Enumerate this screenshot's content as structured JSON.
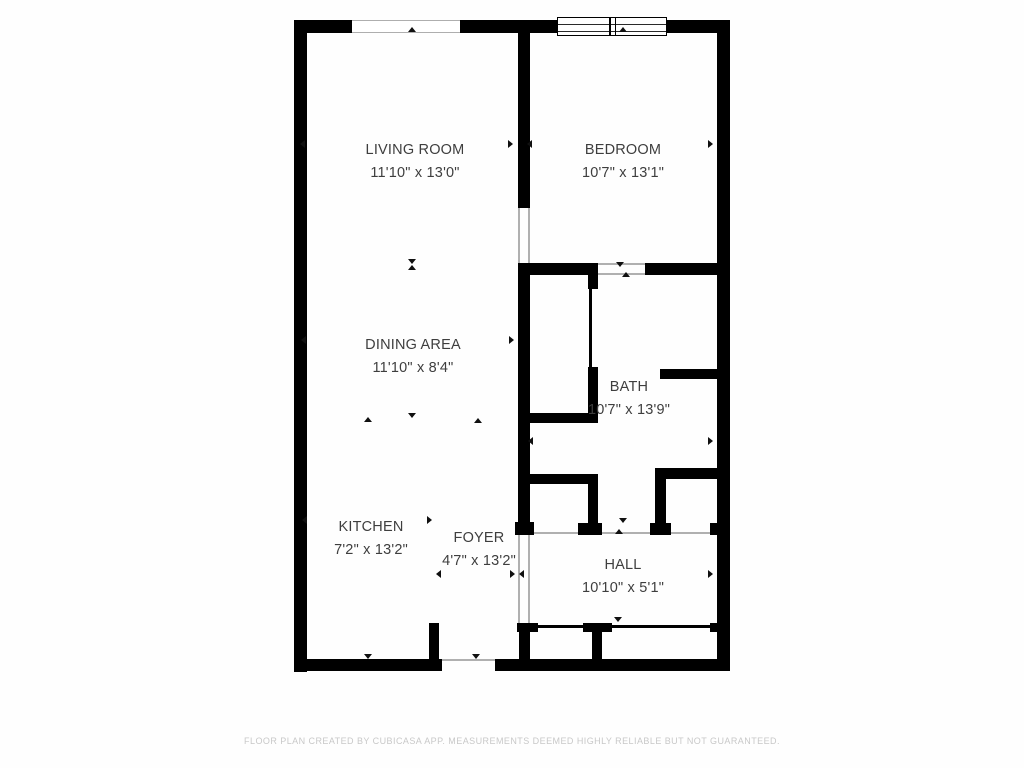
{
  "colors": {
    "background": "#fefefe",
    "wall": "#000000",
    "label_text": "#3e3e3e",
    "footer_text": "#c8c8c8",
    "thin_line": "#b0b0b0"
  },
  "rooms": [
    {
      "id": "living-room",
      "name": "LIVING ROOM",
      "dims": "11'10\" x 13'0\"",
      "cx": 415,
      "top": 139
    },
    {
      "id": "bedroom",
      "name": "BEDROOM",
      "dims": "10'7\" x 13'1\"",
      "cx": 623,
      "top": 139
    },
    {
      "id": "dining-area",
      "name": "DINING AREA",
      "dims": "11'10\" x 8'4\"",
      "cx": 413,
      "top": 334
    },
    {
      "id": "bath",
      "name": "BATH",
      "dims": "10'7\" x 13'9\"",
      "cx": 629,
      "top": 376
    },
    {
      "id": "kitchen",
      "name": "KITCHEN",
      "dims": "7'2\" x 13'2\"",
      "cx": 371,
      "top": 516
    },
    {
      "id": "foyer",
      "name": "FOYER",
      "dims": "4'7\" x 13'2\"",
      "cx": 479,
      "top": 527
    },
    {
      "id": "hall",
      "name": "HALL",
      "dims": "10'10\" x 5'1\"",
      "cx": 623,
      "top": 554
    }
  ],
  "plan": {
    "walls": [
      [
        "left-outer-wall",
        294,
        20,
        13,
        652
      ],
      [
        "top-wall-seg-1",
        294,
        20,
        58,
        13
      ],
      [
        "top-wall-seg-2",
        460,
        20,
        97,
        13
      ],
      [
        "top-wall-seg-3",
        667,
        20,
        63,
        13
      ],
      [
        "right-outer-wall",
        717,
        20,
        13,
        651
      ],
      [
        "bottom-wall-left",
        294,
        659,
        148,
        12
      ],
      [
        "bottom-wall-right",
        495,
        659,
        235,
        12
      ],
      [
        "living-bedroom-wall-upper",
        518,
        33,
        12,
        175
      ],
      [
        "center-wall",
        518,
        263,
        12,
        270
      ],
      [
        "center-wall-foot",
        515,
        522,
        19,
        13
      ],
      [
        "bedroom-south-wall-left",
        518,
        263,
        80,
        12
      ],
      [
        "bedroom-south-wall-right",
        645,
        263,
        85,
        12
      ],
      [
        "closet-east-wall-upper",
        588,
        275,
        10,
        14
      ],
      [
        "closet-east-wall-lower",
        588,
        367,
        10,
        56
      ],
      [
        "closet-south-wall",
        528,
        413,
        67,
        10
      ],
      [
        "bath-east-wall",
        660,
        369,
        70,
        10
      ],
      [
        "bath-south-wall-left",
        528,
        474,
        69,
        10
      ],
      [
        "bath-doorway-stub-left",
        588,
        474,
        10,
        50
      ],
      [
        "bath-doorway-foot-left",
        578,
        523,
        24,
        12
      ],
      [
        "bath-south-wall-right",
        655,
        468,
        75,
        11
      ],
      [
        "bath-doorway-stub-right",
        655,
        468,
        11,
        55
      ],
      [
        "bath-doorway-foot-right",
        650,
        523,
        21,
        12
      ],
      [
        "right-wall-foot",
        710,
        523,
        10,
        12
      ],
      [
        "kitchen-entry-stub",
        429,
        623,
        10,
        37
      ],
      [
        "hall-closet-wall-left",
        519,
        623,
        11,
        37
      ],
      [
        "hall-closet-cap-left",
        517,
        623,
        21,
        9
      ],
      [
        "hall-closet-divider",
        592,
        623,
        10,
        37
      ],
      [
        "hall-closet-divider-cap",
        583,
        623,
        29,
        9
      ],
      [
        "hall-closet-stub-right",
        710,
        623,
        10,
        9
      ]
    ],
    "thin_lines": [
      [
        "bedroom-door-edge-left",
        518,
        208,
        2,
        55
      ],
      [
        "bedroom-door-edge-right",
        528,
        208,
        2,
        55
      ],
      [
        "bedroom-south-door-edge-top",
        598,
        263,
        47,
        2
      ],
      [
        "bedroom-south-door-edge-bottom",
        598,
        273,
        47,
        2
      ],
      [
        "foyer-hall-opening-edge-left",
        518,
        533,
        2,
        90
      ],
      [
        "foyer-hall-opening-edge-right",
        528,
        533,
        2,
        90
      ],
      [
        "entry-door-edge",
        442,
        659,
        53,
        2
      ],
      [
        "hall-top-edge-line",
        530,
        532,
        187,
        1.5
      ]
    ],
    "door_lines": [
      [
        "closet-sliding-door",
        589,
        289,
        2.5,
        78
      ],
      [
        "hall-closet-door-1",
        538,
        625,
        45,
        2.5
      ],
      [
        "hall-closet-door-2",
        612,
        625,
        100,
        2.5
      ]
    ],
    "window": {
      "x": 557,
      "y": 17,
      "w": 110,
      "h": 19,
      "lines_y": [
        5.5,
        12.5
      ],
      "divider_x": [
        51,
        56.5
      ]
    },
    "opening": {
      "x": 352,
      "y": 20,
      "w": 108,
      "h": 13
    },
    "markers": [
      [
        412,
        27,
        "u"
      ],
      [
        623,
        27,
        "u"
      ],
      [
        304,
        144,
        "l"
      ],
      [
        512,
        144,
        "r"
      ],
      [
        531,
        144,
        "l"
      ],
      [
        712,
        144,
        "r"
      ],
      [
        412,
        259,
        "d"
      ],
      [
        412,
        265,
        "u"
      ],
      [
        305,
        340,
        "l"
      ],
      [
        513,
        340,
        "r"
      ],
      [
        620,
        262,
        "d"
      ],
      [
        626,
        272,
        "u"
      ],
      [
        368,
        417,
        "u"
      ],
      [
        412,
        413,
        "d"
      ],
      [
        478,
        418,
        "u"
      ],
      [
        306,
        520,
        "l"
      ],
      [
        431,
        520,
        "r"
      ],
      [
        532,
        441,
        "l"
      ],
      [
        712,
        441,
        "r"
      ],
      [
        623,
        518,
        "d"
      ],
      [
        619,
        529,
        "u"
      ],
      [
        440,
        574,
        "l"
      ],
      [
        514,
        574,
        "r"
      ],
      [
        523,
        574,
        "l"
      ],
      [
        712,
        574,
        "r"
      ],
      [
        618,
        617,
        "d"
      ],
      [
        368,
        654,
        "d"
      ],
      [
        476,
        654,
        "d"
      ]
    ]
  },
  "footer": {
    "text": "FLOOR PLAN CREATED BY CUBICASA APP. MEASUREMENTS DEEMED HIGHLY RELIABLE BUT NOT GUARANTEED."
  }
}
